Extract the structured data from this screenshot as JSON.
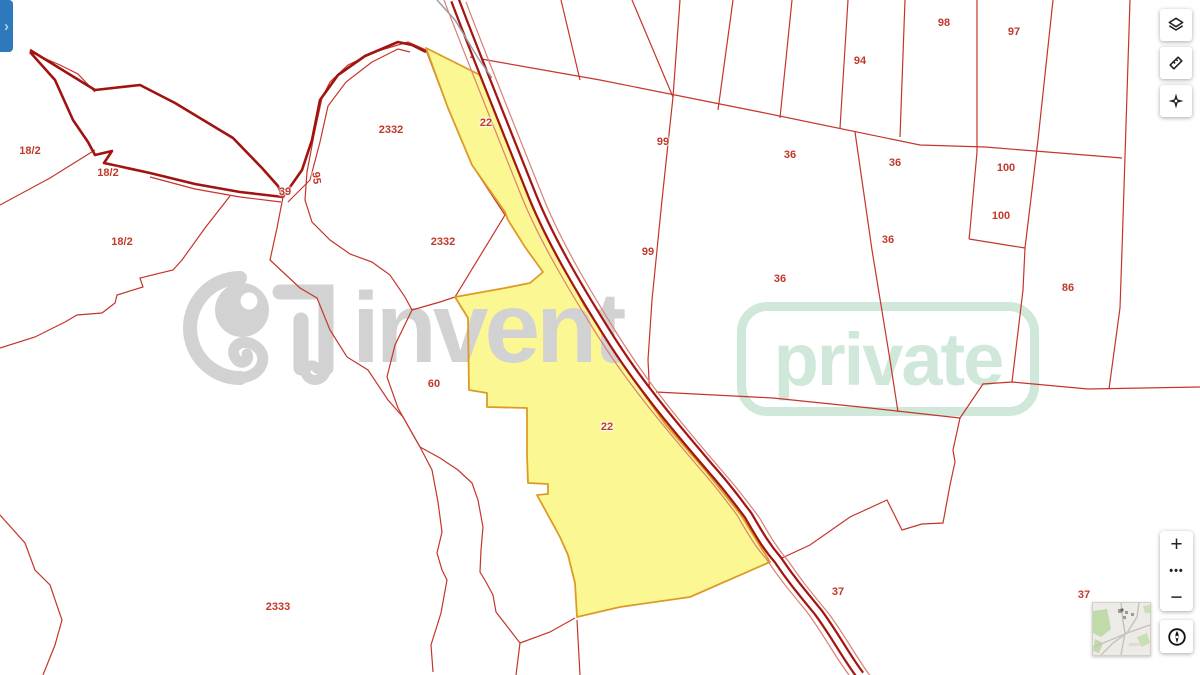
{
  "app": {
    "panel_toggle": "›"
  },
  "toolbar": {
    "buttons": [
      {
        "id": "layers",
        "icon": "layers-icon"
      },
      {
        "id": "measure",
        "icon": "measure-ruler-icon"
      },
      {
        "id": "center",
        "icon": "center-target-icon"
      }
    ]
  },
  "zoom_controls": {
    "zoom_in": "+",
    "more": "•••",
    "zoom_out": "−",
    "compass_icon": "compass-north-icon"
  },
  "minimap": {
    "kind": "overview-map-thumbnail"
  },
  "watermark": {
    "logo": "elephant-swirl-logo",
    "brand": "invent",
    "badge": "private",
    "brand_color": "#d2d2d2",
    "badge_color": "#cfe8da"
  },
  "map": {
    "background": "#ffffff",
    "parcel_line_color": "#c4352b",
    "boundary_thick_color": "#a01310",
    "road_color": "#a51512",
    "highlight_fill": "#fbf893",
    "highlight_stroke": "#dd9b26",
    "label_color": "#c0392b",
    "highlighted_parcel_number": "22",
    "parcel_labels": [
      {
        "text": "18/2",
        "x": 30,
        "y": 151
      },
      {
        "text": "18/2",
        "x": 108,
        "y": 173
      },
      {
        "text": "18/2",
        "x": 122,
        "y": 242
      },
      {
        "text": "39",
        "x": 285,
        "y": 192
      },
      {
        "text": "95",
        "x": 316,
        "y": 178,
        "rot": 83
      },
      {
        "text": "2332",
        "x": 391,
        "y": 130
      },
      {
        "text": "2332",
        "x": 443,
        "y": 242
      },
      {
        "text": "22",
        "x": 486,
        "y": 123
      },
      {
        "text": "22",
        "x": 607,
        "y": 427
      },
      {
        "text": "60",
        "x": 434,
        "y": 384
      },
      {
        "text": "99",
        "x": 663,
        "y": 142
      },
      {
        "text": "99",
        "x": 648,
        "y": 252
      },
      {
        "text": "94",
        "x": 860,
        "y": 61
      },
      {
        "text": "98",
        "x": 944,
        "y": 23
      },
      {
        "text": "97",
        "x": 1014,
        "y": 32
      },
      {
        "text": "36",
        "x": 790,
        "y": 155
      },
      {
        "text": "36",
        "x": 895,
        "y": 163
      },
      {
        "text": "36",
        "x": 888,
        "y": 240
      },
      {
        "text": "36",
        "x": 780,
        "y": 279
      },
      {
        "text": "100",
        "x": 1006,
        "y": 168
      },
      {
        "text": "100",
        "x": 1001,
        "y": 216
      },
      {
        "text": "86",
        "x": 1068,
        "y": 288
      },
      {
        "text": "2333",
        "x": 278,
        "y": 607
      },
      {
        "text": "37",
        "x": 838,
        "y": 592
      },
      {
        "text": "37",
        "x": 1084,
        "y": 595
      }
    ]
  }
}
